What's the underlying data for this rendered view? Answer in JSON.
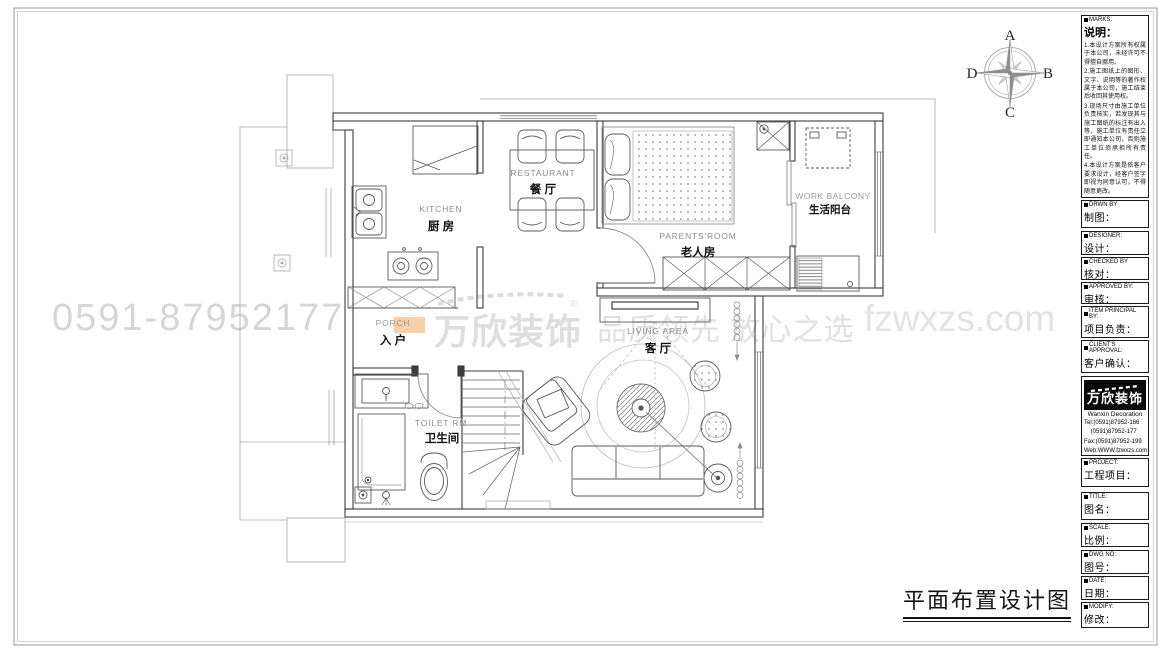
{
  "sheet": {
    "drawing_title": "平面布置设计图"
  },
  "compass": {
    "n": "A",
    "e": "B",
    "s": "C",
    "w": "D"
  },
  "watermark": {
    "phone": "0591-87952177",
    "brand": "万欣装饰",
    "reg": "®",
    "tagline": "品质领先 放心之选",
    "site": "fzwxzs.com"
  },
  "rooms": {
    "kitchen": {
      "en": "KITCHEN",
      "zh": "厨 房"
    },
    "restaurant": {
      "en": "RESTAURANT",
      "zh": "餐 厅"
    },
    "parents": {
      "en": "PARENTS'ROOM",
      "zh": "老人房"
    },
    "balcony": {
      "en": "WORK BALCONY",
      "zh": "生活阳台"
    },
    "porch": {
      "en": "PORCH",
      "zh": "入 户"
    },
    "toilet": {
      "en": "TOILET RM",
      "zh": "卫生间"
    },
    "living": {
      "en": "LIVING AREA",
      "zh": "客 厅"
    }
  },
  "titleblock": {
    "marks_en": "MARKS:",
    "marks_zh": "说明：",
    "notes": [
      "1.本设计方案所有权属于本公司，未经许可不得擅自挪用。",
      "2.施工图纸上的图形、文字、说明等的著作权属于本公司，施工结束后收回其使用权。",
      "3.现场尺寸由施工单位负责核实，若发现其与施工图纸的标注有出入等，施工单位有责任立即通知本公司，否则施工单位须承担所有责任。",
      "4.本设计方案是依客户要求设计，经客户签字即视为同意认可，不得随意更改。"
    ],
    "fields": [
      {
        "en": "DRWN BY",
        "zh": "制图："
      },
      {
        "en": "DESIGNER:",
        "zh": "设计："
      },
      {
        "en": "CHECKED BY",
        "zh": "核对："
      },
      {
        "en": "APPROVED BY:",
        "zh": "审核："
      },
      {
        "en": "ITEM PRINCIPAL BY:",
        "zh": "项目负责："
      },
      {
        "en": "CLIENT'S APPROVAL:",
        "zh": "客户确认："
      },
      {
        "en": "PROJECT:",
        "zh": "工程项目："
      },
      {
        "en": "TITLE:",
        "zh": "图名："
      },
      {
        "en": "SCALE:",
        "zh": "比例："
      },
      {
        "en": "DWG NO:",
        "zh": "图号："
      },
      {
        "en": "DATE:",
        "zh": "日期："
      },
      {
        "en": "MODIFY:",
        "zh": "修改："
      }
    ],
    "company": {
      "logo_zh": "万欣装饰",
      "logo_en": "Wanxin Decoration",
      "tel1": "Tel:(0591)87952-166",
      "tel2": "    (0591)87952-177",
      "fax": "Fax:(0591)87952-199",
      "web": "Web:WWW.fzwxzs.com"
    }
  }
}
